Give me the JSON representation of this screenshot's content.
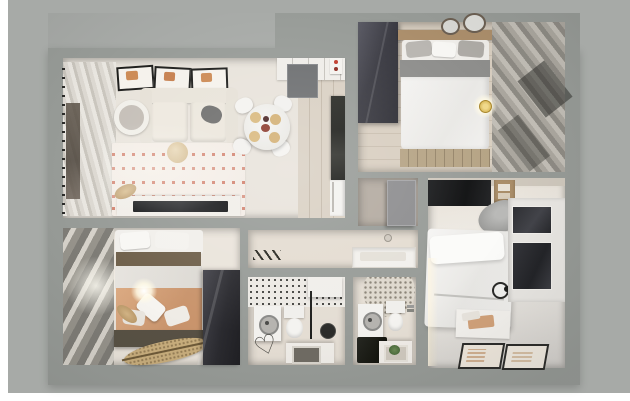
{
  "meta": {
    "description": "3D top-down architectural render of a two-bedroom apartment floor plan on a gray mat",
    "canvas": {
      "width": 630,
      "height": 401
    },
    "visible_text": "none"
  },
  "palette": {
    "page_background": "#ffffff",
    "outer_mat_gray": "#a7aaa7",
    "wall_gray": "#979b97",
    "living_floor": "#e8e3db",
    "kitchen_wood_floor": "#d9d0c3",
    "bedroom_floor": "#eae4db",
    "bathroom_floor": "#e4ddd3",
    "dark_wardrobe": "#2f2f34",
    "sofa_cream": "#ece7dd",
    "rug_base": "#f3ece5",
    "rug_pattern_red": "#c65a42",
    "bed_white": "#f3f2f0",
    "bed_gray_band": "#8e8e8c",
    "bed_olive_band": "#6f604b",
    "bed_salmon": "#d09d77",
    "headboard_wood": "#ab8e6b",
    "curtain_dark": "#7e7c76",
    "curtain_light": "#d6d2ca",
    "window_glass_dark": "#35363a",
    "counter_black": "#20211d",
    "door_gray": "#6d6f71",
    "accent_red": "#c03a2a",
    "rattan_tan": "#c9ae7d",
    "plant_green": "#5e7c4b"
  },
  "rooms": [
    {
      "id": "living-room",
      "furniture": [
        "curtain-wall",
        "window",
        "wall-art-frames-x3",
        "sofa",
        "dark-throw-pillow",
        "round-side-table",
        "patterned-rug",
        "pouf",
        "dining-table",
        "dining-chairs-x4",
        "plates-x4",
        "tv-console",
        "tv",
        "pampas-plant"
      ]
    },
    {
      "id": "kitchen",
      "furniture": [
        "upper-cabinets",
        "entry-door",
        "control-panel-red-dots",
        "black-counter",
        "fridge"
      ]
    },
    {
      "id": "bedroom-top-right",
      "furniture": [
        "dark-wardrobe",
        "double-bed",
        "headboard",
        "pillows",
        "foot-bench",
        "round-mirrors-x2",
        "pendant-light",
        "vertical-blinds",
        "window-dark"
      ]
    },
    {
      "id": "hall-closet",
      "furniture": [
        "door-panel"
      ]
    },
    {
      "id": "corridor",
      "furniture": [
        "coat-rack",
        "white-console"
      ]
    },
    {
      "id": "bedroom-bottom-left",
      "furniture": [
        "vertical-blinds",
        "double-bed",
        "pillows",
        "olive-blanket",
        "salmon-blanket",
        "foot-bench",
        "rattan-rug",
        "pampas-plant",
        "ceiling-light-glow",
        "dark-wardrobe"
      ]
    },
    {
      "id": "bathroom-1",
      "furniture": [
        "mosaic-tile-band",
        "shower-niche",
        "washing-machine",
        "toilet",
        "shower-column",
        "heart-bath-mat",
        "sink-counter"
      ]
    },
    {
      "id": "bathroom-2",
      "furniture": [
        "mosaic-circle",
        "washing-machine",
        "toilet",
        "faucet",
        "dark-stone-counter",
        "sink-with-plant"
      ]
    },
    {
      "id": "bedroom-mid-right",
      "furniture": [
        "tv-panel",
        "wood-shelf",
        "gray-armchair",
        "double-bed",
        "pillows",
        "wire-pendant-lamp",
        "window-wall",
        "bedside-mat-with-clothes",
        "floor-frames-x2"
      ]
    }
  ]
}
